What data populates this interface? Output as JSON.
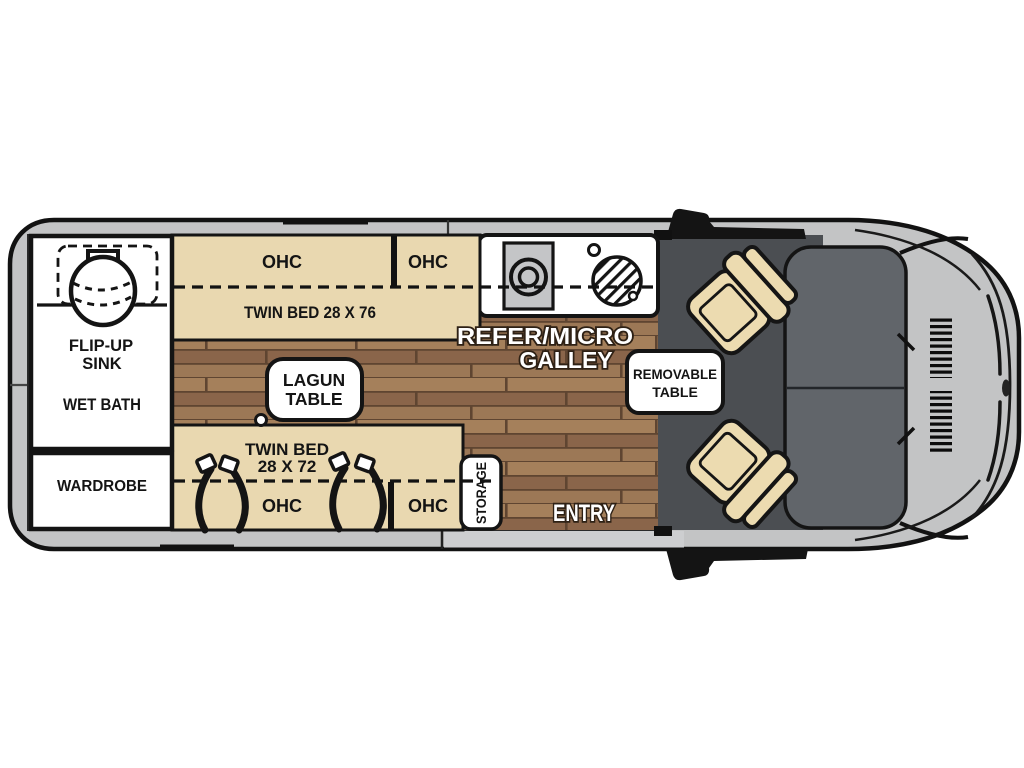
{
  "page": {
    "background": "#ffffff",
    "description": "Top-view floor plan of a Class B camper van"
  },
  "floorplan": {
    "labels": {
      "ohc": "OHC",
      "twin_bed_driver": "TWIN BED 28 X 76",
      "twin_bed_passenger_line1": "TWIN BED",
      "twin_bed_passenger_line2": "28 X 72",
      "flip_up_sink_line1": "FLIP-UP",
      "flip_up_sink_line2": "SINK",
      "wet_bath": "WET BATH",
      "wardrobe": "WARDROBE",
      "lagun_table_line1": "LAGUN",
      "lagun_table_line2": "TABLE",
      "galley_line1": "REFER/MICRO",
      "galley_line2": "GALLEY",
      "removable_table_line1": "REMOVABLE",
      "removable_table_line2": "TABLE",
      "storage": "STORAGE",
      "entry": "ENTRY"
    },
    "colors": {
      "body_gray": "#c3c4c5",
      "outline_black": "#121212",
      "interior_white": "#ffffff",
      "bed_tan": "#e9d8b0",
      "seat_tan": "#ecdbb0",
      "wood_mid": "#96714f",
      "cab_floor_dark": "#4b4e52",
      "windshield_gray": "#61656a",
      "appliance_gray": "#c4c5c7"
    }
  }
}
